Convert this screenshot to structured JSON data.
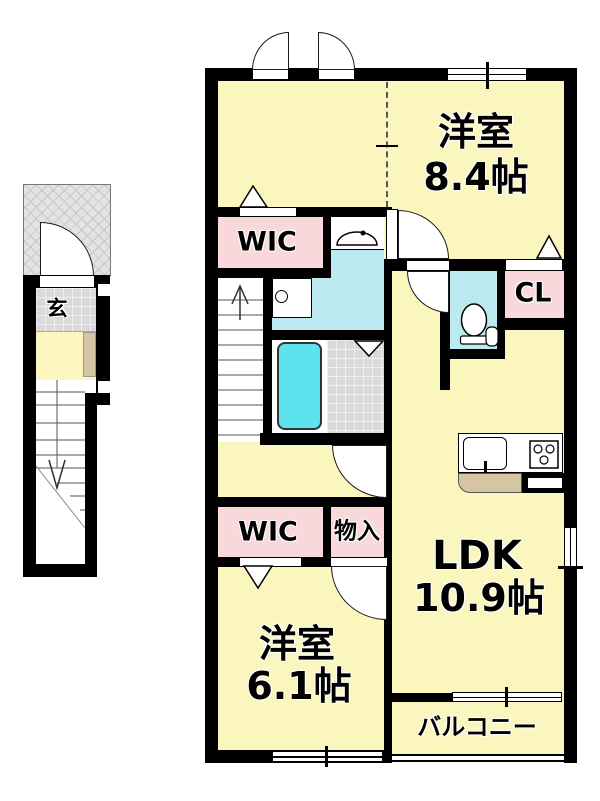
{
  "floor_plan": {
    "rooms": {
      "western_room_1": {
        "label": "洋室",
        "size": "8.4帖"
      },
      "western_room_2": {
        "label": "洋室",
        "size": "6.1帖"
      },
      "ldk": {
        "label": "LDK",
        "size": "10.9帖"
      },
      "wic_upper": {
        "label": "WIC"
      },
      "wic_lower": {
        "label": "WIC"
      },
      "closet": {
        "label": "CL"
      },
      "storage": {
        "label": "物入"
      },
      "balcony": {
        "label": "バルコニー"
      },
      "entrance": {
        "label": "玄"
      }
    },
    "colors": {
      "wall": "#000000",
      "floor_yellow": "#FAF6BD",
      "closet_pink": "#F9D8DB",
      "sanitary_cyan": "#BDEAF0",
      "bathtub_cyan": "#5CE4EE",
      "tile_gray": "#D9D9D9",
      "counter_tan": "#D6C5A2",
      "porch_gray": "#E3E3E3"
    }
  }
}
